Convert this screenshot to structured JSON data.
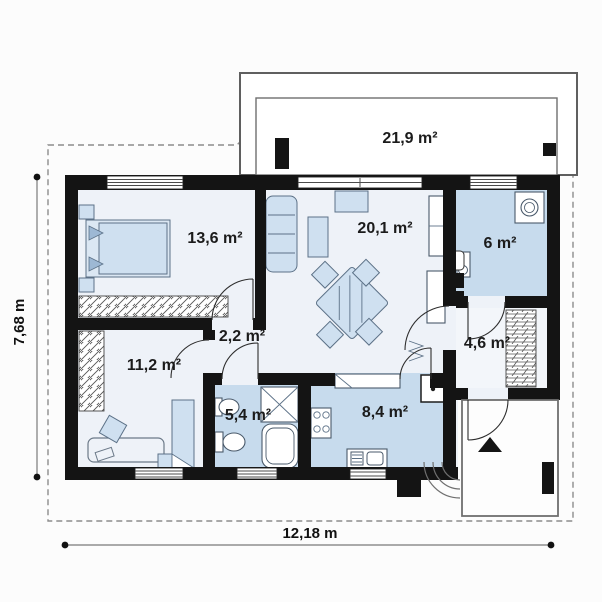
{
  "plan": {
    "labels": {
      "terrace": "21,9 m²",
      "bedroom_main": "13,6 m²",
      "living_room": "20,1 m²",
      "utility": "6 m²",
      "hall_inner": "2,2 m²",
      "hall_entry": "4,6 m²",
      "bedroom_second": "11,2 m²",
      "bathroom": "5,4 m²",
      "kitchen": "8,4 m²"
    },
    "dimensions": {
      "total_width": "12,18 m",
      "total_height": "7,68 m"
    },
    "colors": {
      "wall": "#141414",
      "floor_blue": "#c7dbed",
      "floor_light": "#eef2f8",
      "furniture_fill": "#cfe0f0",
      "furniture_stroke": "#5c7187",
      "plot_dash": "#8c8c8c",
      "text": "#1b1b1b",
      "background": "#fcfcfc"
    }
  }
}
